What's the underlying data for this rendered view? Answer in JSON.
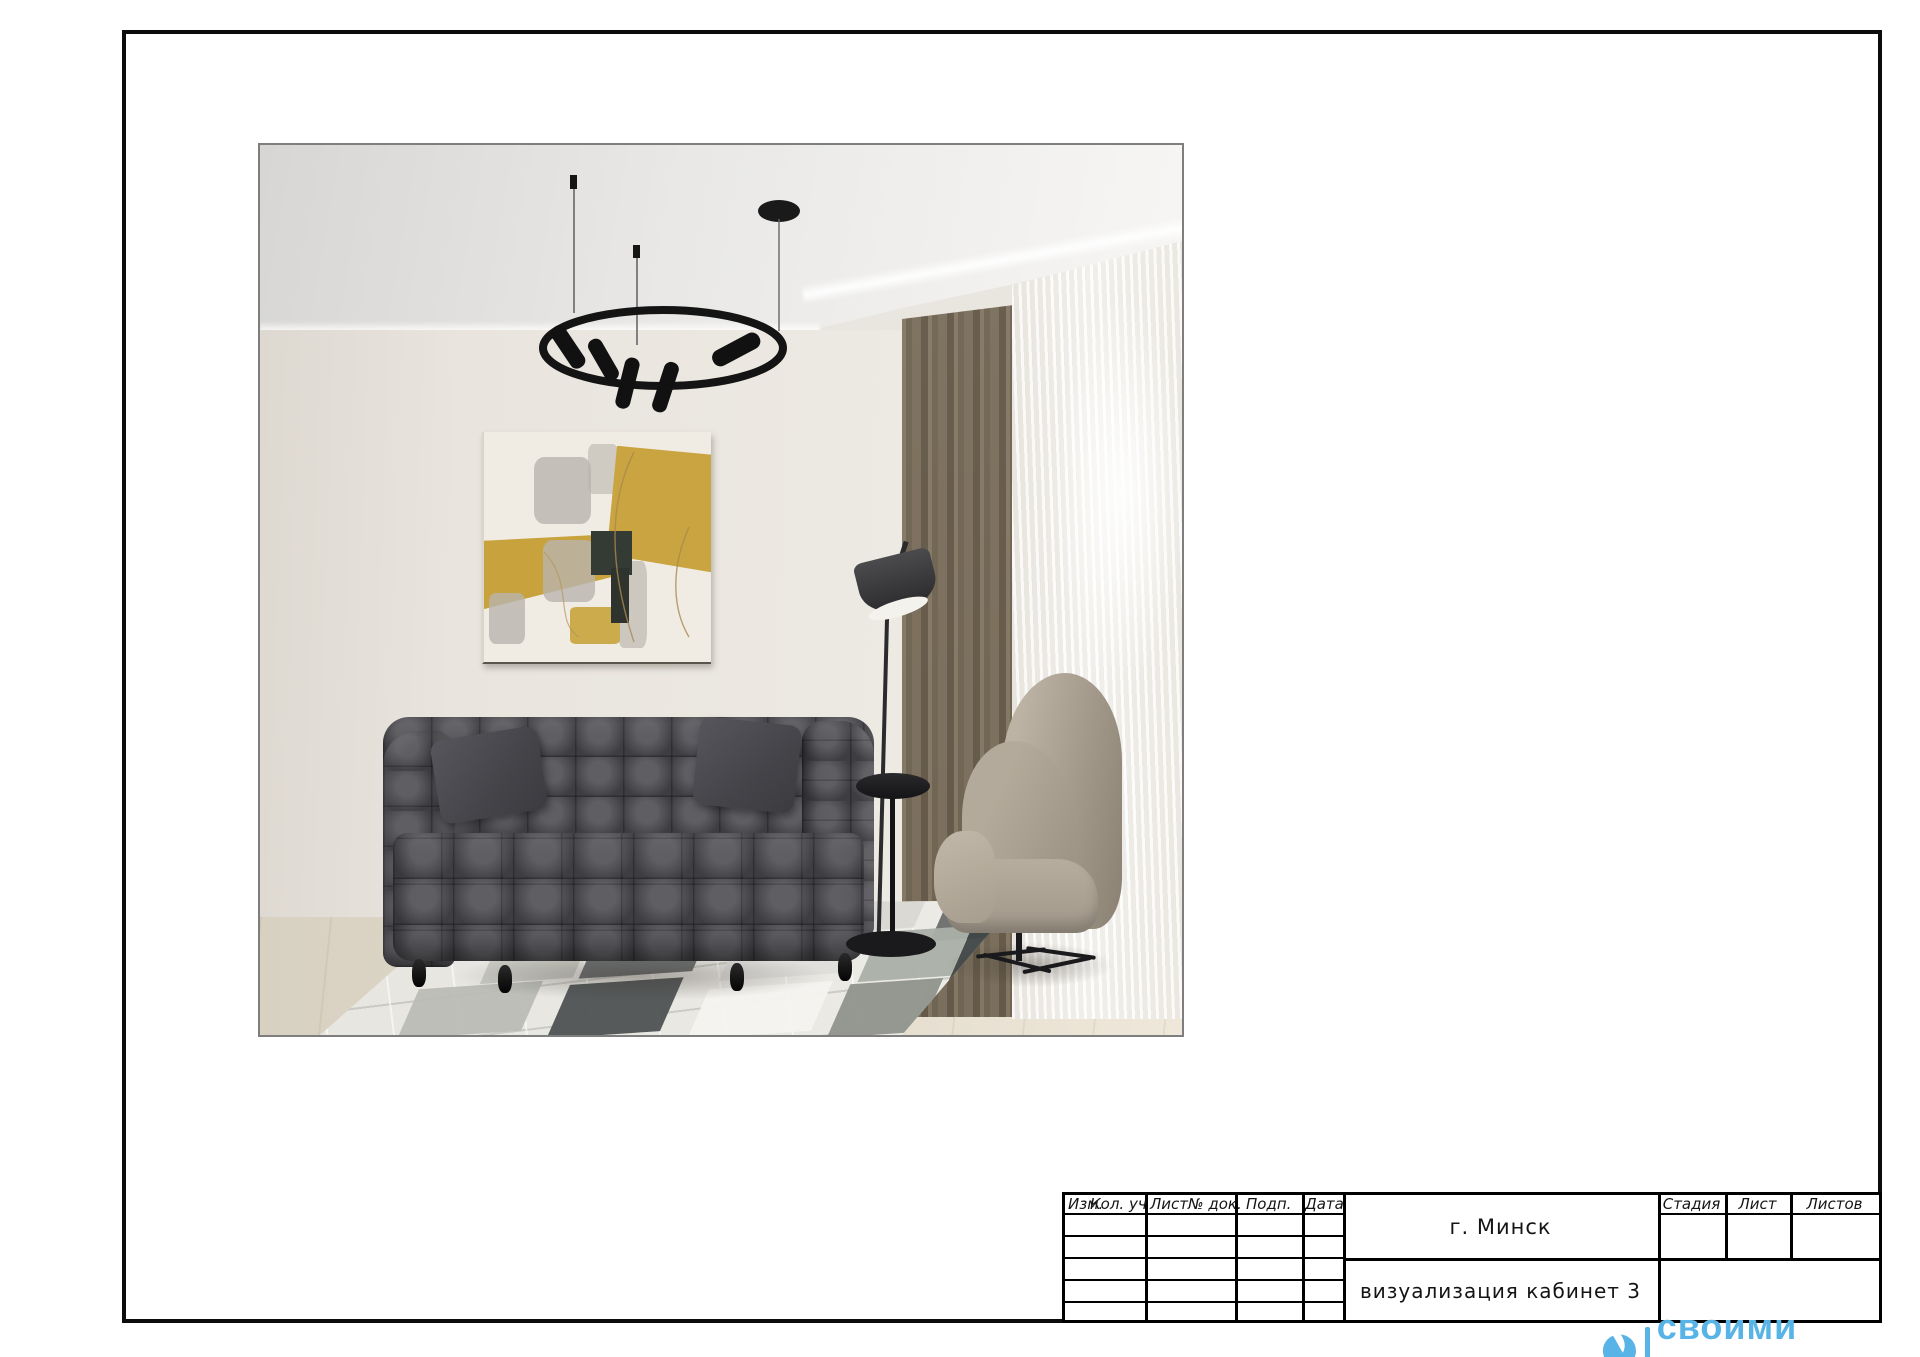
{
  "frame": {
    "border_color": "#0c0c0c"
  },
  "render": {
    "border_color": "#7e7e7e",
    "scene_items": [
      "ring-chandelier",
      "pendant-disc",
      "cove-light",
      "abstract-painting",
      "tufted-sofa",
      "throw-pillows",
      "patchwork-rug",
      "floor-lamp",
      "side-table",
      "wingback-armchair",
      "curtain",
      "sheer-curtain",
      "wood-floor"
    ],
    "colors": {
      "wall": "#e9e5de",
      "ceiling": "#e9e8e6",
      "sofa": "#4d4c51",
      "painting_yellow": "#c8a23d",
      "curtain": "#aba293",
      "armchair": "#a89e8f",
      "rug_dark": "#4e5253",
      "lamp": "#343436"
    }
  },
  "titleblock": {
    "revision_columns": [
      "Изм.",
      "Кол. уч",
      "Лист",
      "№ док.",
      "Подп.",
      "Дата"
    ],
    "empty_rows": 5,
    "city": "г. Минск",
    "title": "визуализация кабинет 3",
    "stage_columns": [
      "Стадия",
      "Лист",
      "Листов"
    ],
    "stage_values": [
      "",
      "",
      ""
    ]
  },
  "watermark": {
    "text": "своими глазами",
    "color": "#58b4e6"
  }
}
